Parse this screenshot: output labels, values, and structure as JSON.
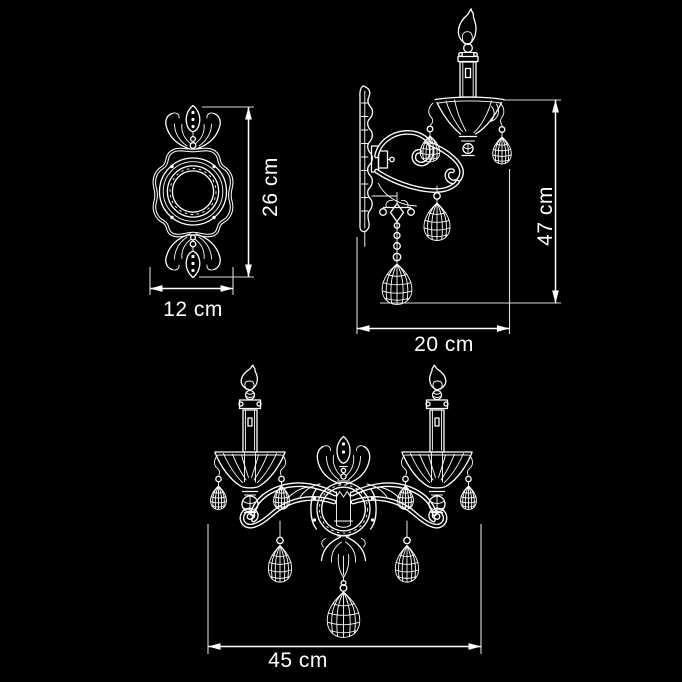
{
  "page": {
    "background": "#000000",
    "ink": "#ffffff"
  },
  "drawing": {
    "kind": "technical dimension diagram",
    "subject": "crystal candle wall sconce",
    "views": [
      {
        "name": "backplate front view",
        "dimensions": [
          {
            "label": "26 cm",
            "orientation": "vertical"
          },
          {
            "label": "12 cm",
            "orientation": "horizontal"
          }
        ]
      },
      {
        "name": "sconce side view",
        "dimensions": [
          {
            "label": "47 cm",
            "orientation": "vertical"
          },
          {
            "label": "20 cm",
            "orientation": "horizontal"
          }
        ]
      },
      {
        "name": "sconce front view",
        "dimensions": [
          {
            "label": "45 cm",
            "orientation": "horizontal"
          }
        ]
      }
    ]
  }
}
